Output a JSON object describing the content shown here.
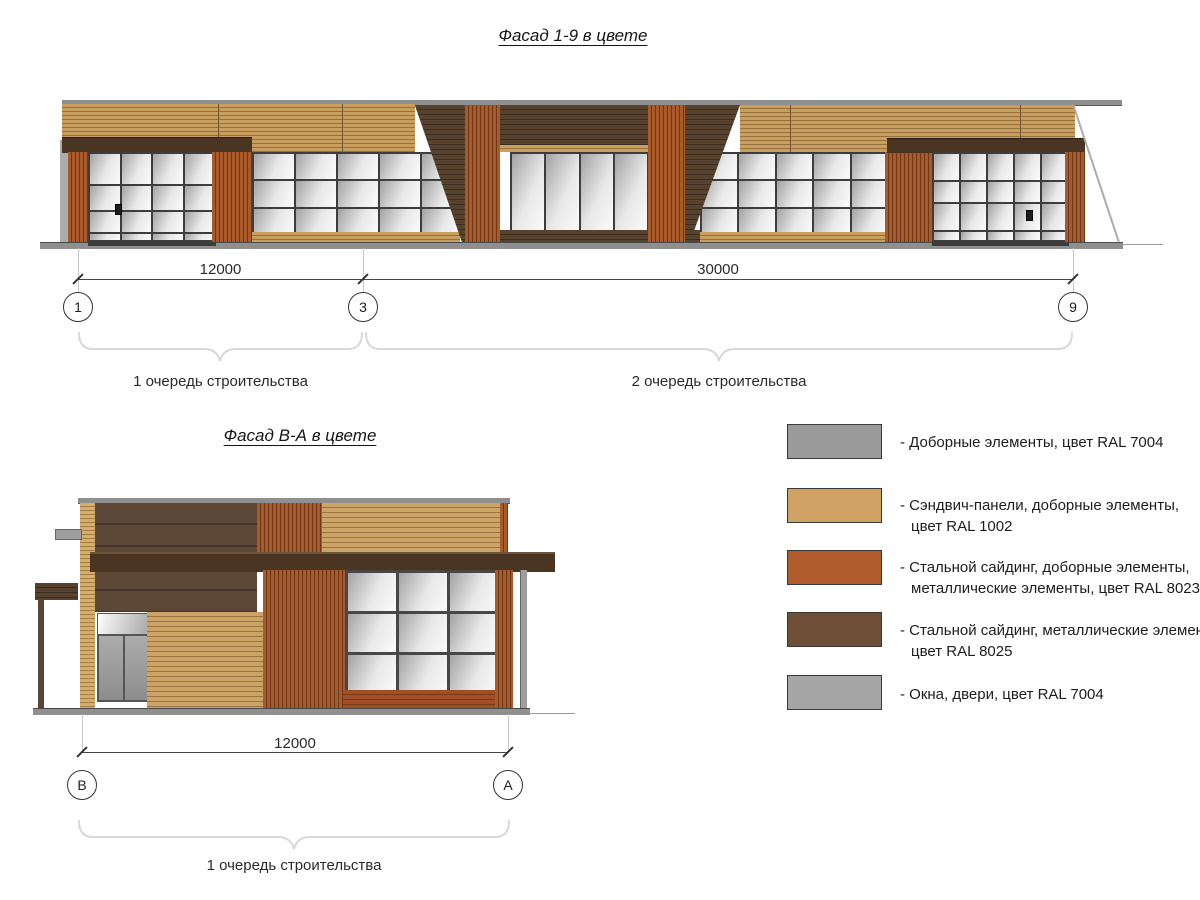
{
  "top_facade": {
    "title": "Фасад 1-9 в цвете",
    "dimensions": [
      {
        "label": "12000"
      },
      {
        "label": "30000"
      }
    ],
    "axes": [
      {
        "label": "1"
      },
      {
        "label": "3"
      },
      {
        "label": "9"
      }
    ],
    "phases": [
      {
        "label": "1 очередь строительства"
      },
      {
        "label": "2 очередь строительства"
      }
    ]
  },
  "side_facade": {
    "title": "Фасад В-А в цвете",
    "dimension": "12000",
    "axes": [
      {
        "label": "В"
      },
      {
        "label": "А"
      }
    ],
    "phase": "1 очередь строительства"
  },
  "legend": {
    "items": [
      {
        "color": "#9A9A9A",
        "lines": [
          "- Доборные элементы, цвет RAL 7004",
          ""
        ]
      },
      {
        "color": "#CFA263",
        "lines": [
          "- Сэндвич-панели, доборные элементы,",
          "цвет RAL 1002"
        ]
      },
      {
        "color": "#AF5B2B",
        "lines": [
          "- Стальной сайдинг, доборные элементы,",
          "металлические элементы, цвет RAL 8023"
        ]
      },
      {
        "color": "#6F4E38",
        "lines": [
          "- Стальной сайдинг, металлические элементы,",
          "цвет RAL 8025"
        ]
      },
      {
        "color": "#A6A6A6",
        "lines": [
          "- Окна, двери, цвет RAL 7004",
          ""
        ]
      }
    ]
  },
  "colors": {
    "ral7004_gray": "#9A9A9A",
    "ral1002_tan": "#CFA263",
    "ral8023_rust": "#AF5B2B",
    "ral8025_brown": "#6F4E38",
    "windows_gray": "#A6A6A6"
  }
}
